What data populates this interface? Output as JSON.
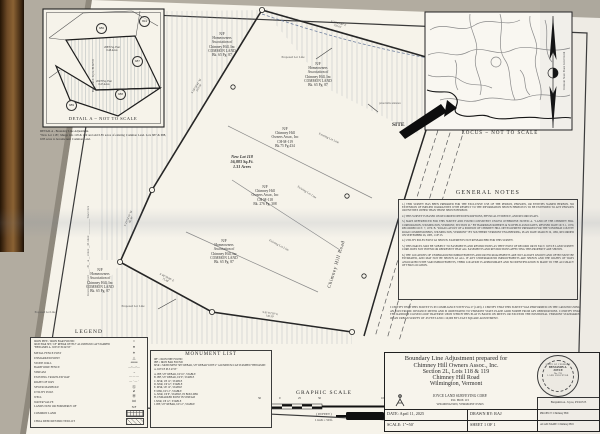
{
  "detail_a": {
    "caption": "DETAIL A ~ NOT TO SCALE",
    "note": "DETAIL A - Boundary Line Adjustment.\n\"New Lot 118\", Merge lots 118 & 119 and add 0.85 acres of existing Common Land. Lots 687 & 688, 0.85 acres to become new Common Land.",
    "lot_686": "686",
    "lot_694": "694",
    "lot_687": "687",
    "lot_688": "688",
    "lot_689": "689",
    "area_687": "20876 Sq. Feet\n0.48 Acres",
    "area_688": "20278 Sq. Feet\n0.47 Acres"
  },
  "locus": {
    "caption": "LOCUS ~ NOT TO SCALE",
    "site": "SITE",
    "north_text": "Vermont State Plane Grid North"
  },
  "plat": {
    "owner_common": "N/F\nHomeowners\nAssociation of\nChimney Hill, Inc\nCOMMON LAND\nBk. 65 Pg. 87",
    "owner_119": "N/F\nChimney Hill\nOwners Assoc, Inc\nCH-M-119\nBk.75 Pg.434",
    "owner_118": "N/F\nChimney Hill\nOwners Assoc, Inc\nCH-M-118\nBk. 276 Pg. 308",
    "new_lot": "New Lot 118\n56,883 Sq.Ft.\n1.31 Acres",
    "existing_lot_line": "Existing Lot Line",
    "proposed_lot_line": "Proposed Lot Line",
    "road_name": "Chimney Hill Road",
    "driveway_label": "paved drive entrance",
    "bearings": [
      "S 28°34'44\" W\n210.04'",
      "S 71°29'30\" E\n192.61'",
      "S 23°54'10\" W\n80.50'",
      "S 81°02'30\" E\n145.30'",
      "S 48°39'48\" E\n75.48'"
    ],
    "edge_note_top": "Benjamin A. Joyce, PLS#725",
    "edge_note_mid": "Received for record ____ , 20__ at __ o'clock __M.  Attest: ____________ Town Clerk"
  },
  "general_notes": {
    "title": "GENERAL NOTES",
    "notes": [
      "1.) THIS SURVEY HAS BEEN PREPARED FOR THE EXCLUSIVE USE OF THE PERSON, PERSONS, OR ENTITIES NAMED HEREON. NO EXTENSION OF IMPLIED WARRANTIES WITH RESPECT TO THE INFORMATION SHOWN HEREON IS TO BE EXTENDED TO ANY PERSONS OR ENTITIES OTHER THAN THOSE SHOWN HEREON.",
      "2.) THIS SURVEY IS BASED ON RECORDED DEED DESCRIPTIONS, PHYSICAL EVIDENCE, AND RECORD PLATS.",
      "3.) MAPS REFERENCED FOR THIS SURVEY AND FOUND CONSISTENT UNLESS OTHERWISE NOTED:  A. \"LAND OF THE CHIMNEY HILL CORPORATION, WILMINGTON, VERMONT, SECTION 2L\" BY HARRIMAN ROBERTS & SCOFIELD ASSOCIATES, REVISED DATE OCT. 1, 1970, RECORDED OCT. 7, 1970.  B. \"ROAD LAYOUT OF A PORTION OF CHIMNEY HILL DEVELOPMENT PREPARED FOR THE WINDHAM COUNTY ROAD COMMISSIONERS, WILMINGTON, VERMONT\" BY SOUTHERN VERMONT ENGINEERING, PLAN DATE MARCH 19, 1982, RECORDED ON SEPTEMBER 26, 1985, 1 OF 23.",
      "4.) UTILITY POLES EXIST AS SHOWN. EASEMENTS NOT RESEARCHED FOR THIS SURVEY.",
      "5.) THIS PARCEL MAY BE SUBJECT TO EASEMENTS AND RESTRICTIONS AS THEY EXIST OF RECORD OR IN FACT. JOYCE LAND SURVEY CORP. DOES NOT INTEND OR REPRESENT THAT ALL EASEMENTS AND RESTRICTIONS AFFECTING THIS PROPERTY ARE SHOWN.",
      "6.) THE LOCATIONS OF UNDERGROUND IMPROVEMENTS AND/OR ENCROACHMENTS ARE NOT ALWAYS KNOWN AND OFTEN MUST BE ESTIMATED, AND MAY NOT BE SHOWN AT ALL. IF ANY UNDERGROUND IMPROVEMENTS ARE SHOWN AND THE RIGHTS OF WAYS ASSOCIATED WITH SAID IMPROVEMENTS, THEIR LOCATION IS APPROXIMATE AND NO IDENTIFICATION IS MADE TO THE ACCURACY OF THAT LOCATION."
    ]
  },
  "certification": "I CERTIFY THAT THIS SURVEY IS IN COMPLIANCE WITH VSA 27 (1403). I CERTIFY THAT THIS SURVEY WAS PERFORMED ON THE GROUND USING AN ELECTRONIC DISTANCE METER AND IS ORIENTATED TO VERMONT STATE PLANE GRID NORTH FROM GPS OBSERVATIONS. I CERTIFY THAT THE RANDOM CLOSED LOOP TRAVERSE UPON WHICH THIS PLAT IS BASED ON MEETS OR EXCEEDS THE POSITIONAL VERMONT STANDARDS OF AN URBAN SURVEY OF .05 FEET AND 1:10,000 BY LEAST SQUARE ADJUSTMENT.",
  "legend": {
    "title": "LEGEND",
    "items": [
      {
        "label": "IRON PIPE / IRON BAR FOUND",
        "symbol": "○"
      },
      {
        "label": "IRON BAR SET, 5/8\" REBAR WITH 2\" ALUMINUM CAP STAMPED \"BENJAMIN A. JOYCE PLS#725\"",
        "symbol": "●"
      },
      {
        "label": "METAL FENCE POST",
        "symbol": "✶"
      },
      {
        "label": "UNMARKED POINT",
        "symbol": "△"
      },
      {
        "label": "STONE WALL",
        "symbol": "oooooo"
      },
      {
        "label": "BARB WIRE FENCE",
        "symbol": "—×—×—"
      },
      {
        "label": "STREAM",
        "symbol": "→"
      },
      {
        "label": "EXISTING TRAVELED WAY",
        "symbol": "— — —"
      },
      {
        "label": "RIGHT OF WAY",
        "symbol": "— · — ·"
      },
      {
        "label": "SEWER MANHOLE",
        "symbol": "Ⓢ"
      },
      {
        "label": "UTILITY POLE",
        "symbol": "⌀"
      },
      {
        "label": "WELL",
        "symbol": "Ⓦ"
      },
      {
        "label": "WATER VALVE",
        "symbol": "⋈"
      },
      {
        "label": "LANDS NOW OR FORMERLY OF",
        "symbol": "N/F"
      },
      {
        "label": "COMMON LAND",
        "symbol": ""
      },
      {
        "label": "CHOA DEED RESTRICTED LOT",
        "symbol": ""
      }
    ]
  },
  "monument_list": {
    "title": "MONUMENT LIST",
    "abbrevs": [
      "IPF = IRON PIPE FOUND",
      "IBF = IRON BAR FOUND",
      "MSR = MONUMENT SET REBAR, 5/8\" REBAR WITH 2\" ALUMINUM CAP STAMPED \"BENJAMIN A. JOYCE PLS #725\""
    ],
    "items": [
      "A. IBF, 5/8\" REBAR, UP 16\", STABLE",
      "B. IBF, 5/8\" REBAR, UP 9\", STABLE",
      "C. MSR, UP 12\", STABLE",
      "D. MSR, UP 12\", STABLE",
      "E. MSR, UP 12\", STABLE",
      "F. MSR, UP 12\", STABLE",
      "G. MSR, UP 6\", STABLE, IN BOULDER",
      "H. UNMARKED POINT IN STREAM",
      "I. MSR, UP 12\", STABLE",
      "J. IBF, 5/8\" REBAR, UP 12\", STABLE"
    ]
  },
  "graphic_scale": {
    "title": "GRAPHIC SCALE",
    "ticks": [
      "50",
      "0",
      "25",
      "50",
      "100"
    ],
    "units": "( IN FEET )",
    "ratio": "1 inch = 50 ft."
  },
  "title_block": {
    "line1": "Boundary Line Adjustment prepared for",
    "line2": "Chimney Hill Owners Assoc., Inc.",
    "line3": "Section 2L, Lots 118 & 119",
    "line4": "Chimney Hill Road",
    "line5": "Wilmington, Vermont",
    "firm": "JOYCE LAND SURVEYING CORP.",
    "addr1": "P.O. BOX 115",
    "addr2": "WILMINGTON, VERMONT 05363",
    "date": "DATE: April 11, 2025",
    "drawn": "DRAWN BY: RAJ",
    "project": "PROJECT: Chimney Hill",
    "scale": "SCALE: 1\"=50'",
    "sheet": "SHEET 1 OF 1",
    "acad": "ACAD NAME: Chimney Hill",
    "seal_top": "STATE OF VERMONT",
    "seal_name": "BENJAMIN A.\nJOYCE",
    "seal_no": "No. 725",
    "seal_bottom": "LAND SURVEYOR",
    "signer": "Benjamin A. Joyce, PLS#725"
  }
}
